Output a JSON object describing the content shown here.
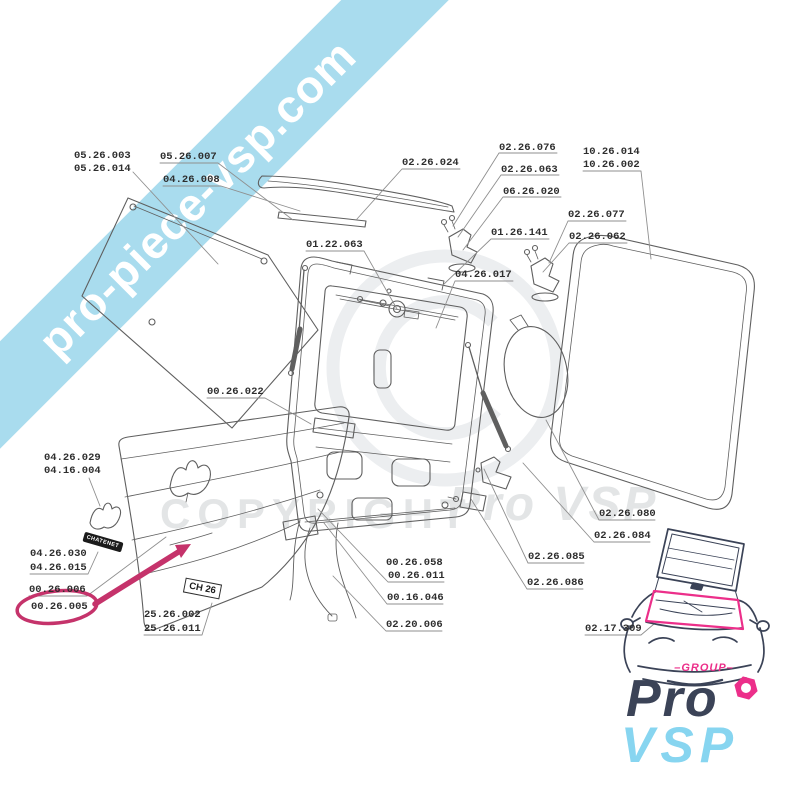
{
  "banner": {
    "text": "pro-piece-vsp.com"
  },
  "watermark": {
    "line": "COPYRIGHT",
    "brand": "Pro VSP"
  },
  "logo": {
    "group": "–GROUP–",
    "pro": "Pro",
    "vsp": "VSP"
  },
  "plates": {
    "brand": "CHATENET",
    "model": "CH 26"
  },
  "highlight": {
    "part": "00.26.005",
    "color": "#c5336b"
  },
  "colors": {
    "banner_blue": "#a9dcee",
    "highlight_pink": "#c5336b",
    "logo_pink": "#ec2f8a",
    "logo_navy": "#3b4357",
    "logo_cyan": "#87d5f0",
    "line_gray": "#5f5f5f"
  },
  "labels": [
    {
      "text": "05.26.003"
    },
    {
      "text": "05.26.014"
    },
    {
      "text": "05.26.007"
    },
    {
      "text": "04.26.008"
    },
    {
      "text": "02.26.024"
    },
    {
      "text": "02.26.076"
    },
    {
      "text": "02.26.063"
    },
    {
      "text": "06.26.020"
    },
    {
      "text": "10.26.014"
    },
    {
      "text": "10.26.002"
    },
    {
      "text": "02.26.077"
    },
    {
      "text": "02.26.062"
    },
    {
      "text": "01.26.141"
    },
    {
      "text": "01.22.063"
    },
    {
      "text": "04.26.017"
    },
    {
      "text": "00.26.022"
    },
    {
      "text": "04.26.029"
    },
    {
      "text": "04.16.004"
    },
    {
      "text": "04.26.030"
    },
    {
      "text": "04.26.015"
    },
    {
      "text": "00.26.006"
    },
    {
      "text": "00.26.005"
    },
    {
      "text": "25.26.002"
    },
    {
      "text": "25.26.011"
    },
    {
      "text": "00.26.058"
    },
    {
      "text": "00.26.011"
    },
    {
      "text": "00.16.046"
    },
    {
      "text": "02.20.006"
    },
    {
      "text": "02.26.085"
    },
    {
      "text": "02.26.086"
    },
    {
      "text": "02.26.080"
    },
    {
      "text": "02.26.084"
    },
    {
      "text": "02.17.309"
    }
  ]
}
